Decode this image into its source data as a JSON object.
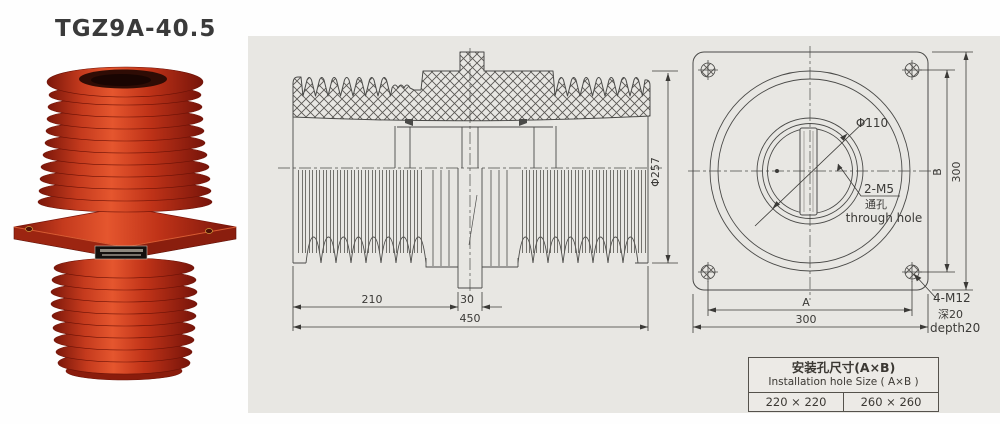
{
  "title": "TGZ9A-40.5",
  "colors": {
    "panel_bg": "#e8e7e3",
    "drawing_line": "#4a4a48",
    "insulator_red": "#c43a1d",
    "insulator_dark_red": "#8a1c0c"
  },
  "section_view": {
    "dim_left": "210",
    "dim_conductor": "30",
    "dim_total": "450",
    "dim_diameter": "Φ257"
  },
  "front_view": {
    "dim_center_hole": "Φ110",
    "label_m5": "2-M5",
    "label_m5_cn": "通孔",
    "label_m5_en": "through hole",
    "dim_b": "B",
    "dim_height": "300",
    "dim_a": "A",
    "dim_width": "300",
    "label_m12": "4-M12",
    "label_m12_cn": "深20",
    "label_m12_en": "depth20"
  },
  "table": {
    "title_cn": "安装孔尺寸(A×B)",
    "title_en": "Installation hole Size ( A×B )",
    "values": [
      "220 × 220",
      "260 × 260"
    ]
  }
}
